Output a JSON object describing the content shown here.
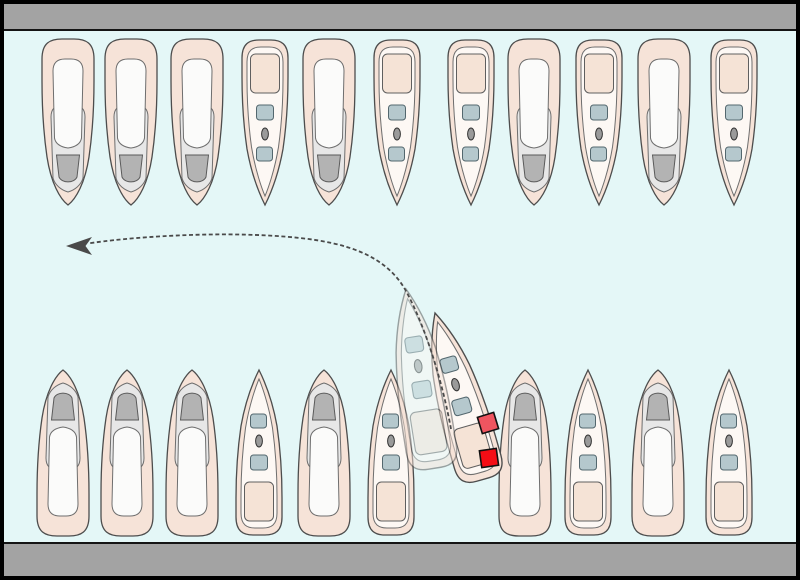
{
  "scene": {
    "width": 800,
    "height": 580,
    "description_name": "marina-slip-departure-diagram",
    "colors": {
      "water": "#e4f7f7",
      "dock": "#a3a3a3",
      "edge": "#141414",
      "hull": "#f6e3d8",
      "hull_stroke": "#4d4d4d",
      "deck": "#fdf8f4",
      "deck_stroke": "#6e6e6e",
      "graydeck": "#e7e7e7",
      "cabin": "#fbfbfa",
      "windshield": "#b3b3b3",
      "seat": "#b5c8cd",
      "seat_stroke": "#53676e",
      "wheel": "#9a9a9a",
      "pad": "#f5e3d6",
      "fender_upper": "#ef5560",
      "fender_lower": "#f50d15",
      "arrow": "#4a4a4a"
    },
    "docks": {
      "top": {
        "x": 2,
        "y": 2,
        "width": 796,
        "height": 28
      },
      "bottom": {
        "x": 2,
        "y": 543,
        "width": 796,
        "height": 34
      }
    },
    "top_row": {
      "direction": "bows-pointing-down",
      "tip_y": 205,
      "boats": [
        {
          "type": "cruiser",
          "x": 68
        },
        {
          "type": "cruiser",
          "x": 131
        },
        {
          "type": "cruiser",
          "x": 197
        },
        {
          "type": "runabout",
          "x": 265
        },
        {
          "type": "cruiser",
          "x": 329
        },
        {
          "type": "runabout",
          "x": 397
        },
        {
          "type": "runabout",
          "x": 471
        },
        {
          "type": "cruiser",
          "x": 534
        },
        {
          "type": "runabout",
          "x": 599
        },
        {
          "type": "cruiser",
          "x": 664
        },
        {
          "type": "runabout",
          "x": 734
        }
      ]
    },
    "bottom_row": {
      "direction": "bows-pointing-up",
      "bow_y": 370,
      "empty_slip_x": 458,
      "boats": [
        {
          "type": "cruiser",
          "x": 63
        },
        {
          "type": "cruiser",
          "x": 127
        },
        {
          "type": "cruiser",
          "x": 192
        },
        {
          "type": "runabout",
          "x": 259
        },
        {
          "type": "cruiser",
          "x": 324
        },
        {
          "type": "runabout",
          "x": 391
        },
        {
          "type": "cruiser",
          "x": 525
        },
        {
          "type": "runabout",
          "x": 588
        },
        {
          "type": "cruiser",
          "x": 658
        },
        {
          "type": "runabout",
          "x": 729
        }
      ]
    },
    "maneuvering_boat": {
      "type": "runabout",
      "current": {
        "bow_x": 435,
        "bow_y": 313,
        "rotation": -16,
        "scale": 1.05
      },
      "ghost": {
        "bow_x": 406,
        "bow_y": 289,
        "rotation": -9,
        "scale": 1.1,
        "opacity": 0.5
      },
      "fenders": [
        {
          "cx": 488,
          "cy": 423,
          "size": 17,
          "angle": -17,
          "color": "#ef5560"
        },
        {
          "cx": 489,
          "cy": 458,
          "size": 17,
          "angle": -8,
          "color": "#f50d15"
        }
      ]
    },
    "trajectory": {
      "path": "M451,429 C443,385 427,330 406,291 C386,255 346,243 300,238 C220,229.5 122,238 88,243.5",
      "arrowhead_points": "66,246 92,237 85.5,246 92,255",
      "dash_pattern": "4 2.6"
    }
  }
}
